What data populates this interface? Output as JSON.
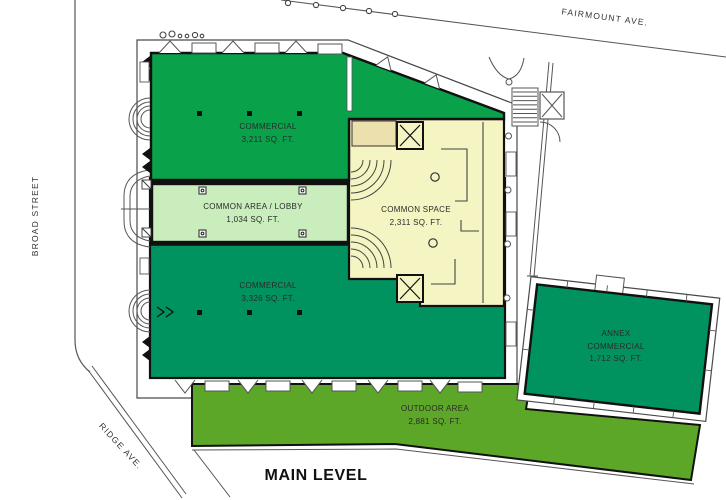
{
  "title": "MAIN LEVEL",
  "streets": {
    "left": "BROAD STREET",
    "top": "FAIRMOUNT AVE.",
    "diagonal": "RIDGE AVE."
  },
  "zones": [
    {
      "id": "commercial-north",
      "name": "COMMERCIAL",
      "area": "3,211 SQ. FT.",
      "color": "#0AA14B"
    },
    {
      "id": "common-area-lobby",
      "name": "COMMON AREA / LOBBY",
      "area": "1,034 SQ. FT.",
      "color": "#C9EDBD"
    },
    {
      "id": "common-space",
      "name": "COMMON SPACE",
      "area": "2,311 SQ. FT.",
      "color": "#F5F5C3"
    },
    {
      "id": "commercial-south",
      "name": "COMMERCIAL",
      "area": "3,326 SQ. FT.",
      "color": "#00935F"
    },
    {
      "id": "annex-commercial",
      "name": "ANNEX COMMERCIAL",
      "area": "1,712 SQ. FT.",
      "color": "#00935F"
    },
    {
      "id": "outdoor-area",
      "name": "OUTDOOR AREA",
      "area": "2,881 SQ. FT.",
      "color": "#5CA727"
    }
  ],
  "colors": {
    "beige_vestibule": "#EBE0AE",
    "wall": "#111111",
    "outline": "#4a4a4a",
    "background": "#FFFFFF",
    "label_text": "#2a2a2a"
  }
}
